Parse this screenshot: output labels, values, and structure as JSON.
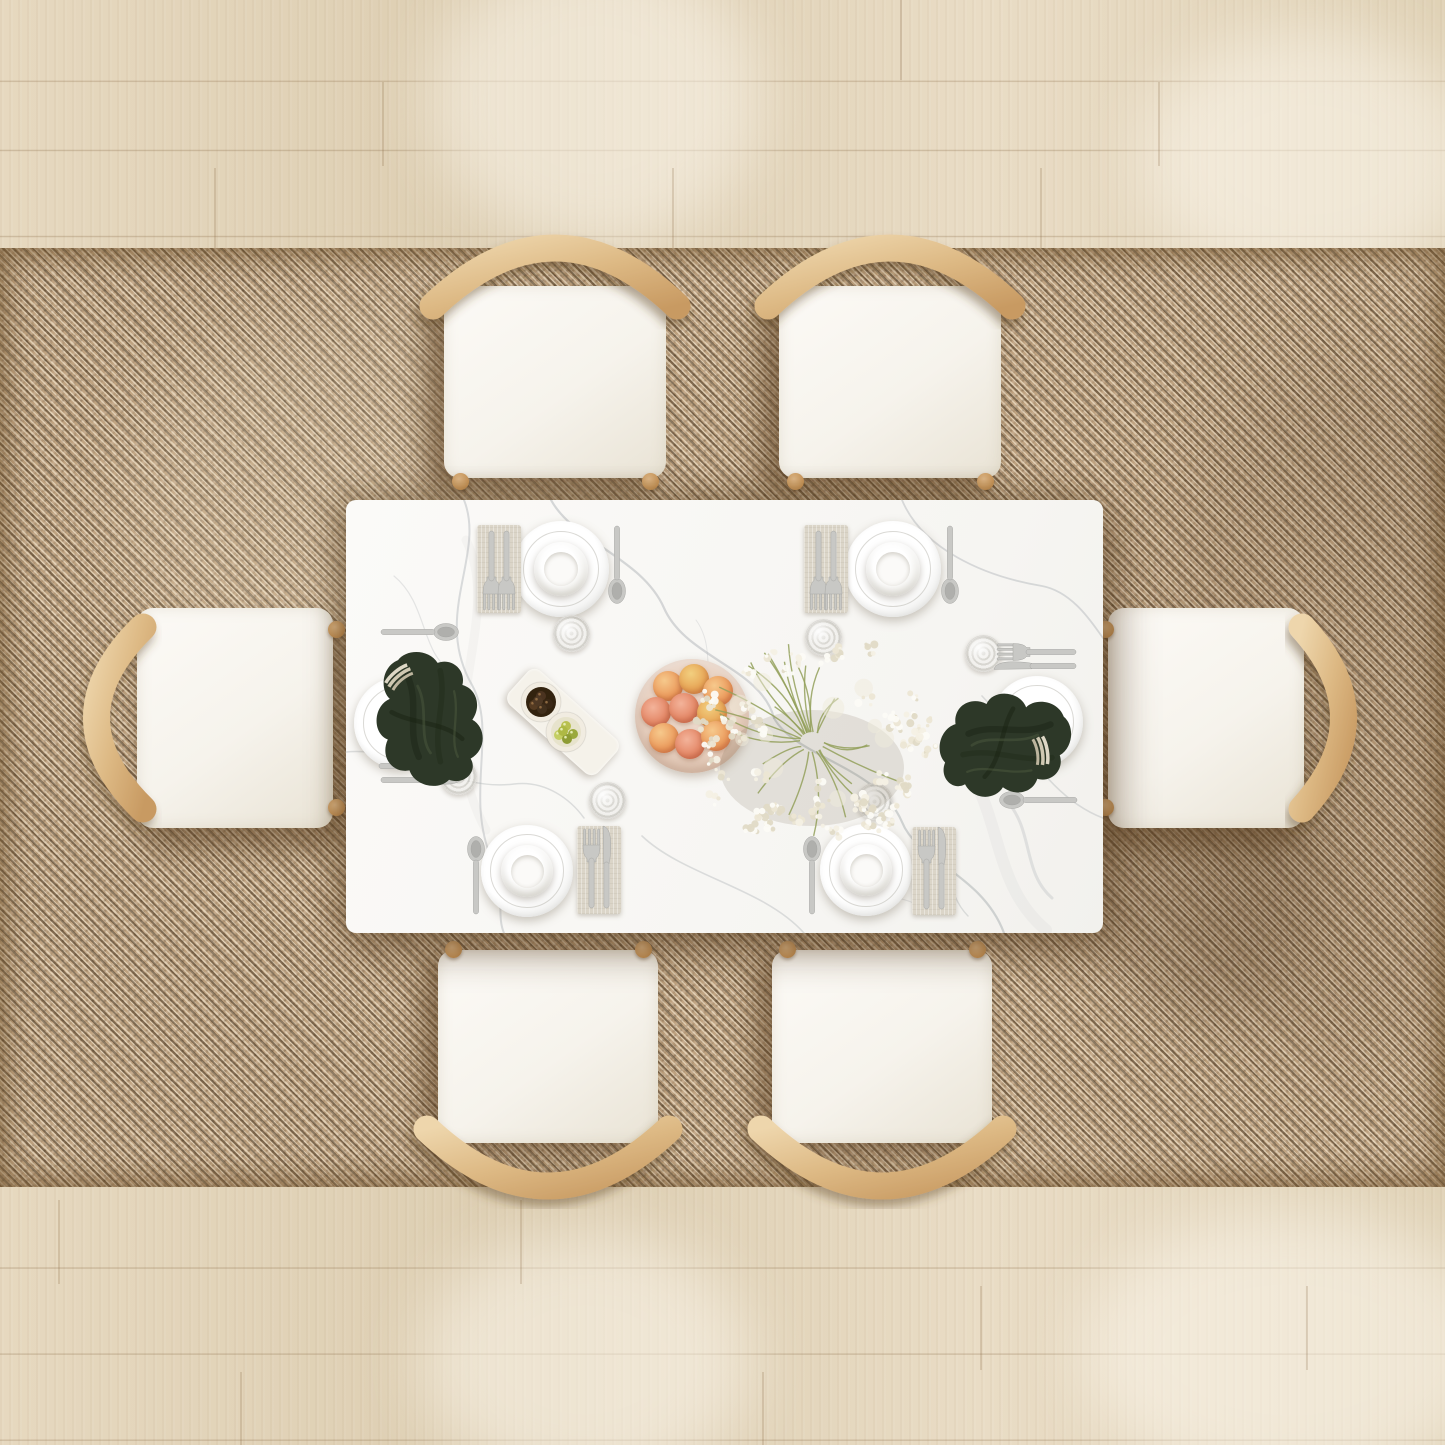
{
  "meta": {
    "width": 1445,
    "height": 1445,
    "description": "Top-down view of a white marble dining table set for six, with light-wood arched-back chairs on a woven jute rug over pale oak plank flooring"
  },
  "palette": {
    "floor": "#e1d3b9",
    "floor_seam": "rgba(138,108,72,0.28)",
    "floor_light": "rgba(255,252,243,0.5)",
    "rug": "#bfa381",
    "rug_dark": "rgba(62,45,25,0.5)",
    "rug_light": "rgba(255,244,222,0.5)",
    "table": "#f8f7f4",
    "vein": "#afb4b7",
    "wood": "#e3c094",
    "wood_deep": "#cda06a",
    "cushion": "#f6f3ec",
    "cushion_edge": "#e9e3d5",
    "plate": "#ffffff",
    "napkin_linen": "#dbd5c8",
    "silver": "#c8c8c5",
    "napkin_green": "#2d3828",
    "napkin_green_dark": "#1c2517",
    "fruit_plate": "#e4cab7",
    "stem": "#93a05a",
    "petal": "#f3efe2",
    "olive_dark": "#43301c",
    "olive_green": "#adb84c",
    "tray": "#f5f2ea",
    "glass": "#f2f1ee",
    "shadow": "rgba(95,68,38,0.45)"
  },
  "furniture": {
    "rug": {
      "name": "woven jute area rug",
      "x": 0,
      "y": 248,
      "w": 1445,
      "h": 939
    },
    "table": {
      "name": "white marble dining table",
      "x": 346,
      "y": 500,
      "w": 757,
      "h": 433
    },
    "chairs": [
      {
        "side": "north",
        "cx": 555,
        "label": "top-left chair"
      },
      {
        "side": "north",
        "cx": 890,
        "label": "top-right chair"
      },
      {
        "side": "south",
        "cx": 548,
        "label": "bottom-left chair"
      },
      {
        "side": "south",
        "cx": 882,
        "label": "bottom-right chair"
      },
      {
        "side": "west",
        "cy": 718,
        "label": "left chair"
      },
      {
        "side": "east",
        "cy": 718,
        "label": "right chair"
      }
    ]
  },
  "place_settings": [
    {
      "id": "north-left",
      "plate": {
        "x": 561,
        "y": 569,
        "d": 96,
        "bowl": true
      },
      "napkin": {
        "x": 499,
        "y": 569,
        "w": 44,
        "h": 88
      },
      "napkin_cutlery": [
        "fork",
        "fork"
      ],
      "cutlery_rot": 180,
      "loose": [
        {
          "type": "spoon",
          "x": 617,
          "y": 566,
          "rot": 180
        }
      ],
      "glass": {
        "x": 571,
        "y": 633
      }
    },
    {
      "id": "north-right",
      "plate": {
        "x": 893,
        "y": 569,
        "d": 96,
        "bowl": true
      },
      "napkin": {
        "x": 826,
        "y": 569,
        "w": 44,
        "h": 88
      },
      "napkin_cutlery": [
        "fork",
        "fork"
      ],
      "cutlery_rot": 180,
      "loose": [
        {
          "type": "spoon",
          "x": 950,
          "y": 566,
          "rot": 180
        }
      ],
      "glass": {
        "x": 823,
        "y": 637
      }
    },
    {
      "id": "south-left",
      "plate": {
        "x": 527,
        "y": 871,
        "d": 92,
        "bowl": true
      },
      "napkin": {
        "x": 599,
        "y": 870,
        "w": 44,
        "h": 88
      },
      "napkin_cutlery": [
        "fork",
        "knife"
      ],
      "cutlery_rot": 0,
      "loose": [
        {
          "type": "spoon",
          "x": 476,
          "y": 874,
          "rot": 0
        }
      ],
      "glass": {
        "x": 607,
        "y": 800
      }
    },
    {
      "id": "south-right",
      "plate": {
        "x": 866,
        "y": 870,
        "d": 92,
        "bowl": true
      },
      "napkin": {
        "x": 934,
        "y": 871,
        "w": 44,
        "h": 88
      },
      "napkin_cutlery": [
        "fork",
        "knife"
      ],
      "cutlery_rot": 0,
      "loose": [
        {
          "type": "spoon",
          "x": 812,
          "y": 874,
          "rot": 0
        }
      ],
      "glass": {
        "x": 874,
        "y": 801
      }
    },
    {
      "id": "west",
      "plate": {
        "x": 400,
        "y": 723,
        "d": 92,
        "bowl": false
      },
      "green_napkin": {
        "tx": 432,
        "ty": 716,
        "rot": 8,
        "scale": 0.92,
        "knot": {
          "x": 399,
          "y": 677,
          "rot": -40
        }
      },
      "loose": [
        {
          "type": "spoon",
          "x": 421,
          "y": 632,
          "rot": 90
        },
        {
          "type": "fork",
          "x": 419,
          "y": 766,
          "rot": 90
        },
        {
          "type": "knife",
          "x": 421,
          "y": 780,
          "rot": 90
        }
      ],
      "glass": {
        "x": 458,
        "y": 776
      }
    },
    {
      "id": "east",
      "plate": {
        "x": 1037,
        "y": 722,
        "d": 92,
        "bowl": false
      },
      "green_napkin": {
        "tx": 1008,
        "ty": 748,
        "rot": 100,
        "scale": 0.9,
        "knot": {
          "x": 1041,
          "y": 751,
          "rot": 80
        }
      },
      "loose": [
        {
          "type": "fork",
          "x": 1036,
          "y": 652,
          "rot": -90
        },
        {
          "type": "knife",
          "x": 1036,
          "y": 666,
          "rot": -90
        },
        {
          "type": "spoon",
          "x": 1037,
          "y": 800,
          "rot": -90
        }
      ],
      "glass": {
        "x": 983,
        "y": 653
      }
    }
  ],
  "centerpiece": {
    "fruit_bowl": {
      "name": "bowl of peaches",
      "x": 692,
      "y": 716,
      "d": 114,
      "fruits": [
        {
          "dx": -24,
          "dy": -30,
          "v": "a"
        },
        {
          "dx": 2,
          "dy": -37,
          "v": "c"
        },
        {
          "dx": 26,
          "dy": -25,
          "v": "a"
        },
        {
          "dx": -36,
          "dy": -4,
          "v": "b"
        },
        {
          "dx": -8,
          "dy": -8,
          "v": "b"
        },
        {
          "dx": 20,
          "dy": -3,
          "v": "c"
        },
        {
          "dx": -28,
          "dy": 22,
          "v": "a"
        },
        {
          "dx": -2,
          "dy": 28,
          "v": "b"
        },
        {
          "dx": 24,
          "dy": 20,
          "v": "a"
        }
      ]
    },
    "bouquet": {
      "name": "babys-breath bouquet",
      "cx": 812,
      "cy": 742,
      "radius": 120,
      "stems": 26,
      "clusters": 54,
      "seed": 7,
      "petal_colors": [
        "#f4f0e4",
        "#ece6d4",
        "#fcfbf5",
        "#e0dac6"
      ]
    },
    "olive_tray": {
      "name": "appetizer tray",
      "x": 563,
      "y": 722,
      "w": 120,
      "h": 46,
      "rot": 42,
      "bowls": [
        {
          "x": 541,
          "y": 702,
          "contents": "dark olives"
        },
        {
          "x": 566,
          "y": 732,
          "contents": "green olives"
        }
      ]
    }
  }
}
